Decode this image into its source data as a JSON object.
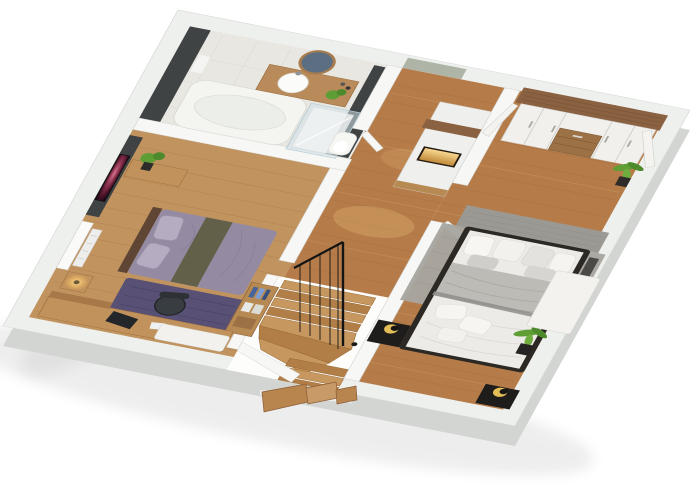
{
  "scene": {
    "title": "3D cutaway floor plan render - upper storey",
    "view": "isometric top-down architectural visualization",
    "background": "#ffffff"
  },
  "palette": {
    "slabTop": "#eef0ee",
    "slabFace": "#d3d5d2",
    "wallTop": "#f7f7f5",
    "wallStroke": "#d4d4d1",
    "floorWood": "#b57c49",
    "floorWoodLight": "#c1935f",
    "floorBath": "#e9e7e1",
    "darkWall": "#3f4344",
    "sageWall": "#aeb5a7",
    "greyWall": "#9b9994",
    "woodAccent": "#8a6242",
    "woodFurniture": "#c2925c",
    "duvetPurple": "#948ba2",
    "stripeOlive": "#63604a",
    "rugPurple": "#585175",
    "rugGrey": "#a8a59f",
    "duvetWhite": "#edebe7",
    "blanketGrey": "#bdbbb6",
    "bedFrameDark": "#2c2823",
    "nightstandBlack": "#1e1d1b",
    "lampGold": "#e3bd55",
    "glassBlue": "#cfe0e8",
    "plantGreen": "#5f9e35",
    "nicheGlow": "#f4c469",
    "treadLight": "#c6975f",
    "treadDark": "#b27e48",
    "railBlack": "#141414"
  },
  "rooms": [
    {
      "name": "bathroom",
      "furniture": [
        "bathtub",
        "wood-vanity-counter",
        "round-basin",
        "round-mirror",
        "walk-in-glass-shower",
        "toilet",
        "towel",
        "counter-plant",
        "charcoal-accent-walls"
      ]
    },
    {
      "name": "bedroom-left",
      "furniture": [
        "double-bed-purple-duvet",
        "olive-stripe-runner",
        "wall-tv-nebula-screen",
        "wood-sideboard",
        "plant",
        "window-radiator",
        "nightstand-warm-lamp",
        "purple-rug",
        "wood-desk",
        "office-chair",
        "laptop",
        "white-bench",
        "cubby-shelf-blue-books"
      ]
    },
    {
      "name": "hallway-landing",
      "furniture": [
        "wall-unit-led-niche",
        "wood-shelf-band",
        "winder-staircase-to-lower-floor",
        "white-stringer-walls",
        "black-metal-railing",
        "ceiling-light-pools"
      ]
    },
    {
      "name": "bedroom-master",
      "furniture": [
        "double-bed-white-grey-bedding",
        "dark-bed-frame",
        "two-black-nightstands",
        "gold-sphere-lamps",
        "grey-textured-rug",
        "grey-headboard-wall-panel",
        "white-wardrobe-wood-cornice",
        "center-wood-drawers",
        "open-wardrobe-doors",
        "potted-plants",
        "dark-tv-panel",
        "white-desk",
        "open-white-door"
      ]
    }
  ]
}
